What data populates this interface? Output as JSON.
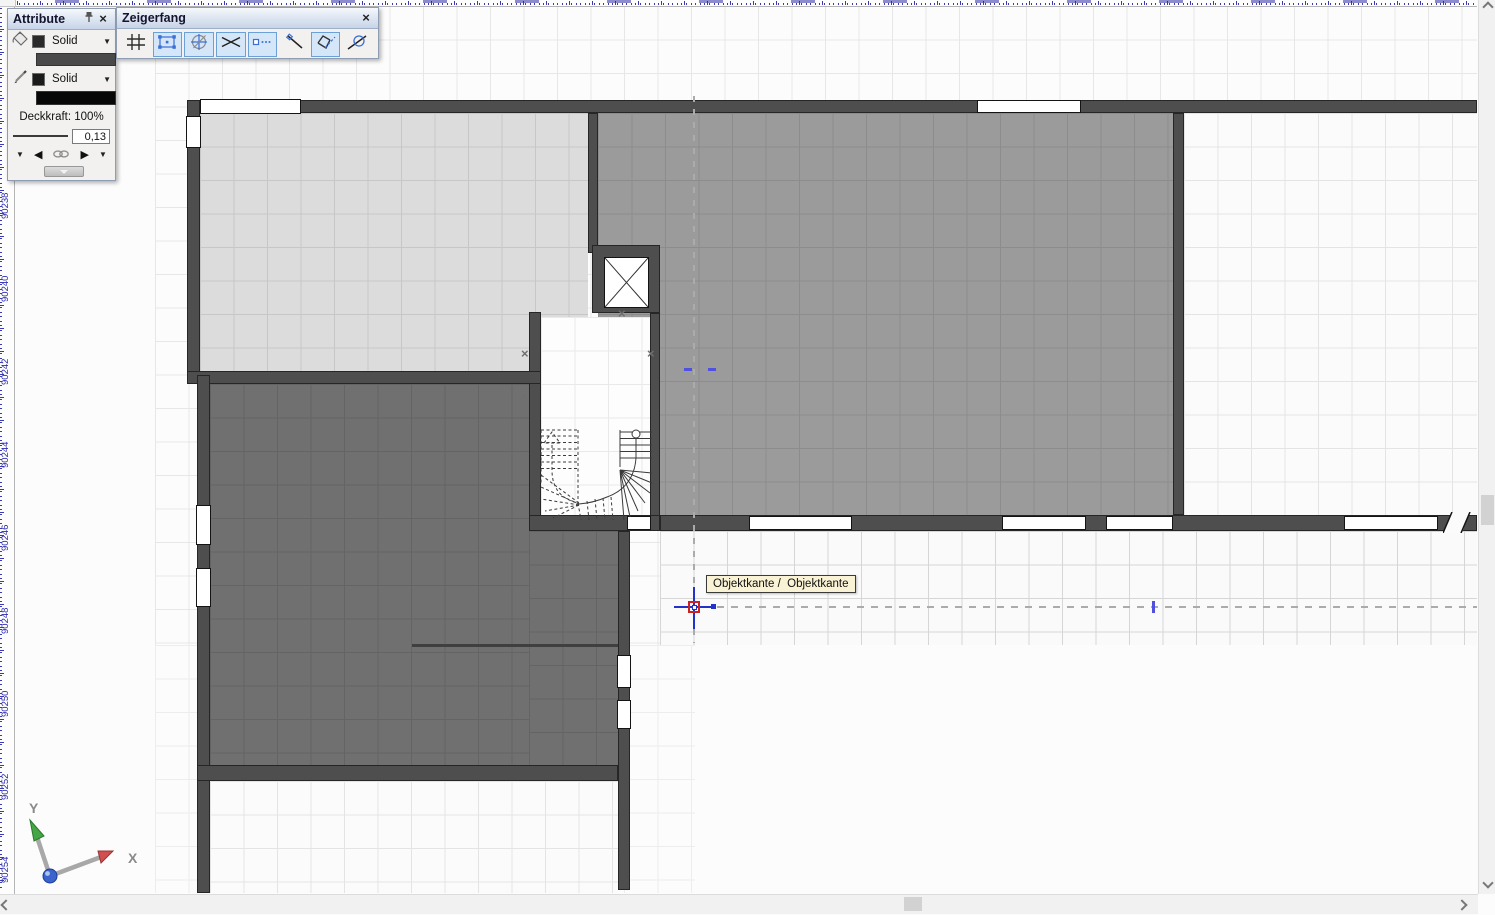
{
  "panels": {
    "attribute": {
      "title": "Attribute",
      "surface_style_label": "Solid",
      "pen_style_label": "Solid",
      "opacity_label": "Deckkraft: 100%",
      "pen_width_value": "0,13",
      "surface_color": "#4a4a4a",
      "pen_color": "#0a0a0a"
    },
    "zeigerfang": {
      "title": "Zeigerfang",
      "buttons": [
        {
          "name": "grid-snap",
          "active": false
        },
        {
          "name": "vertex-snap",
          "active": true
        },
        {
          "name": "center-snap",
          "active": true
        },
        {
          "name": "intersection-snap",
          "active": true
        },
        {
          "name": "element-point-snap",
          "active": true
        },
        {
          "name": "perpendicular-snap",
          "active": false
        },
        {
          "name": "edge-snap",
          "active": true
        },
        {
          "name": "tangent-snap",
          "active": false
        }
      ]
    }
  },
  "canvas": {
    "tooltip_text": "Objektkante /  Objektkante",
    "axis_x_label": "X",
    "axis_y_label": "Y",
    "left_ruler_labels": [
      "90238",
      "90240",
      "90242",
      "90244",
      "90246",
      "90248",
      "90250",
      "90252",
      "90254"
    ],
    "colors": {
      "wall": "#4e4e4e",
      "room_light": "#dcdcdc",
      "room_medium": "#9b9b9b",
      "room_dark": "#707070",
      "guide_blue": "#4646dd",
      "cursor_red": "#cc2222"
    }
  }
}
